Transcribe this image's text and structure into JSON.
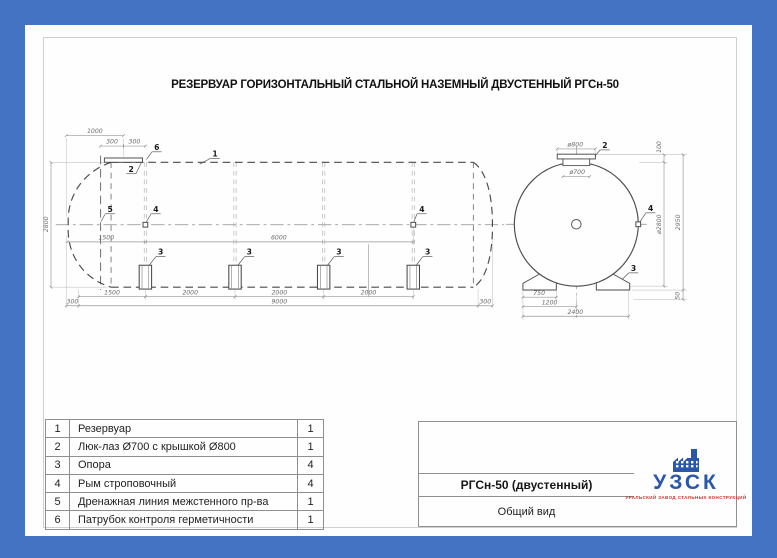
{
  "page": {
    "title": "РЕЗЕРВУАР ГОРИЗОНТАЛЬНЫЙ СТАЛЬНОЙ НАЗЕМНЫЙ ДВУСТЕННЫЙ РГСн-50"
  },
  "colors": {
    "page_background": "#4573c4",
    "sheet": "#fefefe",
    "logo_blue": "#2b57ab",
    "logo_red": "#cf2e26"
  },
  "drawing": {
    "side_view": {
      "dim_1000": "1000",
      "dim_300a": "300",
      "dim_300b": "300",
      "dim_2800": "2800",
      "dim_1500_mid": "1500",
      "dim_6000": "6000",
      "dim_1500_bot": "1500",
      "dim_2000a": "2000",
      "dim_2000b": "2000",
      "dim_2000c": "2000",
      "dim_300_left": "300",
      "dim_9000": "9000",
      "dim_300_right": "300",
      "callout_1": "1",
      "callout_2": "2",
      "callout_3": "3",
      "callout_4": "4",
      "callout_5": "5",
      "callout_6": "6"
    },
    "end_view": {
      "dim_d800": "ø800",
      "dim_d700": "ø700",
      "dim_100": "100",
      "dim_d2800": "ø2800",
      "dim_2950": "2950",
      "dim_50": "50",
      "dim_750": "750",
      "dim_1200": "1200",
      "dim_2400": "2400",
      "callout_2": "2",
      "callout_3": "3",
      "callout_4": "4"
    }
  },
  "parts_table": {
    "rows": [
      {
        "num": "1",
        "name": "Резервуар",
        "qty": "1"
      },
      {
        "num": "2",
        "name": "Люк-лаз Ø700 с крышкой Ø800",
        "qty": "1"
      },
      {
        "num": "3",
        "name": "Опора",
        "qty": "4"
      },
      {
        "num": "4",
        "name": "Рым строповочный",
        "qty": "4"
      },
      {
        "num": "5",
        "name": "Дренажная линия межстенного пр-ва",
        "qty": "1"
      },
      {
        "num": "6",
        "name": "Патрубок контроля герметичности",
        "qty": "1"
      }
    ]
  },
  "title_block": {
    "model": "РГСн-50 (двустенный)",
    "view": "Общий вид"
  },
  "logo": {
    "name": "УЗСК",
    "tagline": "УРАЛЬСКИЙ ЗАВОД СТАЛЬНЫХ КОНСТРУКЦИЙ"
  }
}
